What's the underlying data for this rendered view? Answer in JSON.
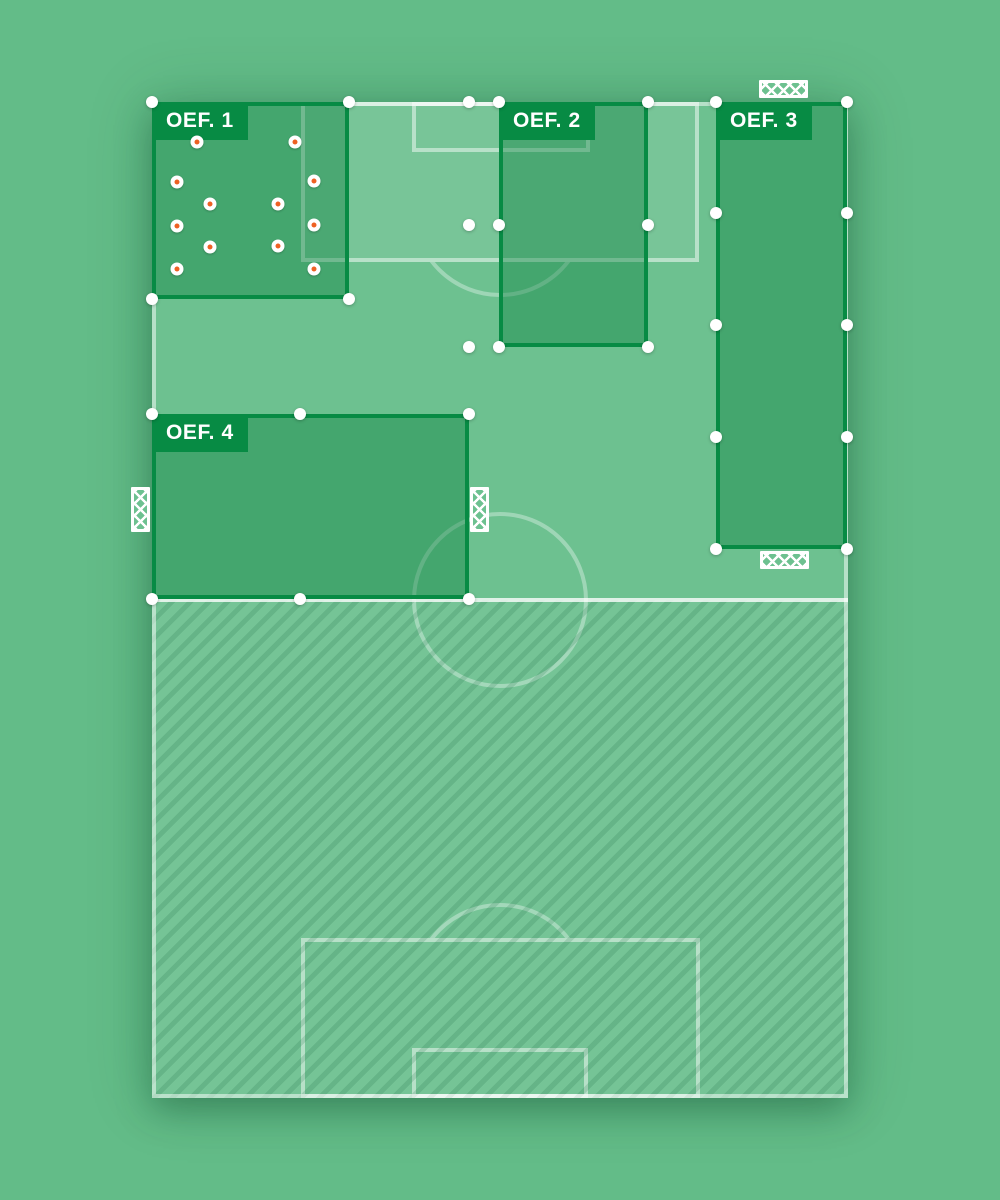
{
  "canvas": {
    "width": 1000,
    "height": 1200,
    "background": "#63bc88"
  },
  "colors": {
    "pitch_green": "#6dc190",
    "zone_fill": "rgba(8,125,60,0.40)",
    "zone_border": "#078b44",
    "badge_green": "#078b44",
    "badge_text": "#ffffff",
    "pitch_line": "rgba(255,255,255,0.48)",
    "halfway_line": "rgba(255,255,255,0.78)",
    "handle_white": "#ffffff",
    "cone_orange": "#ee6123"
  },
  "pitch": {
    "x": 152,
    "y": 102,
    "w": 696,
    "h": 996
  },
  "markings": {
    "penalty_area_top": {
      "x": 301,
      "y": 102,
      "w": 398,
      "h": 160,
      "tinted": true
    },
    "goal_area_top": {
      "x": 412,
      "y": 102,
      "w": 178,
      "h": 50,
      "tinted": false
    },
    "penalty_area_bottom": {
      "x": 301,
      "y": 938,
      "w": 399,
      "h": 160,
      "tinted": false
    },
    "goal_area_bottom": {
      "x": 412,
      "y": 1048,
      "w": 176,
      "h": 50,
      "tinted": false
    },
    "center_circle": {
      "cx": 500,
      "cy": 600,
      "r": 88
    },
    "penalty_arc_top": {
      "cx": 500,
      "cy": 209,
      "r": 88,
      "clip_y1": 262,
      "clip_y2": 302
    },
    "penalty_arc_bottom": {
      "cx": 500,
      "cy": 991,
      "r": 88,
      "clip_y1": 898,
      "clip_y2": 938
    },
    "halfway_line": {
      "x": 152,
      "y": 598,
      "w": 696
    },
    "hatched_bottom_half": {
      "x": 152,
      "y": 600,
      "w": 696,
      "h": 498
    }
  },
  "zones": [
    {
      "id": "oef-1",
      "label": "OEF. 1",
      "x": 152,
      "y": 102,
      "w": 197,
      "h": 197,
      "handles": [
        [
          152,
          102
        ],
        [
          349,
          102
        ],
        [
          152,
          299
        ],
        [
          349,
          299
        ]
      ],
      "cones": [
        [
          197,
          142
        ],
        [
          295,
          142
        ],
        [
          177,
          182
        ],
        [
          314,
          181
        ],
        [
          210,
          204
        ],
        [
          278,
          204
        ],
        [
          177,
          226
        ],
        [
          314,
          225
        ],
        [
          210,
          247
        ],
        [
          278,
          246
        ],
        [
          177,
          269
        ],
        [
          314,
          269
        ]
      ]
    },
    {
      "id": "oef-2",
      "label": "OEF. 2",
      "x": 499,
      "y": 102,
      "w": 149,
      "h": 245,
      "handles": [
        [
          499,
          102
        ],
        [
          648,
          102
        ],
        [
          499,
          225
        ],
        [
          648,
          225
        ],
        [
          499,
          347
        ],
        [
          648,
          347
        ]
      ],
      "cones": []
    },
    {
      "id": "oef-3",
      "label": "OEF. 3",
      "x": 716,
      "y": 102,
      "w": 131,
      "h": 447,
      "handles": [
        [
          716,
          102
        ],
        [
          847,
          102
        ],
        [
          716,
          213
        ],
        [
          847,
          213
        ],
        [
          716,
          325
        ],
        [
          847,
          325
        ],
        [
          716,
          437
        ],
        [
          847,
          437
        ],
        [
          716,
          549
        ],
        [
          847,
          549
        ]
      ],
      "cones": []
    },
    {
      "id": "oef-4",
      "label": "OEF. 4",
      "x": 152,
      "y": 414,
      "w": 317,
      "h": 185,
      "handles": [
        [
          152,
          414
        ],
        [
          300,
          414
        ],
        [
          469,
          414
        ],
        [
          152,
          599
        ],
        [
          300,
          599
        ],
        [
          469,
          599
        ]
      ],
      "cones": []
    }
  ],
  "detached_handles": [
    [
      469,
      102
    ],
    [
      469,
      225
    ],
    [
      469,
      347
    ]
  ],
  "goals": [
    {
      "id": "goal-top",
      "x": 759,
      "y": 80,
      "w": 49,
      "h": 18
    },
    {
      "id": "goal-mid-right",
      "x": 760,
      "y": 551,
      "w": 49,
      "h": 18
    },
    {
      "id": "goal-left",
      "x": 131,
      "y": 487,
      "w": 19,
      "h": 45
    },
    {
      "id": "goal-right",
      "x": 470,
      "y": 487,
      "w": 19,
      "h": 45
    }
  ]
}
